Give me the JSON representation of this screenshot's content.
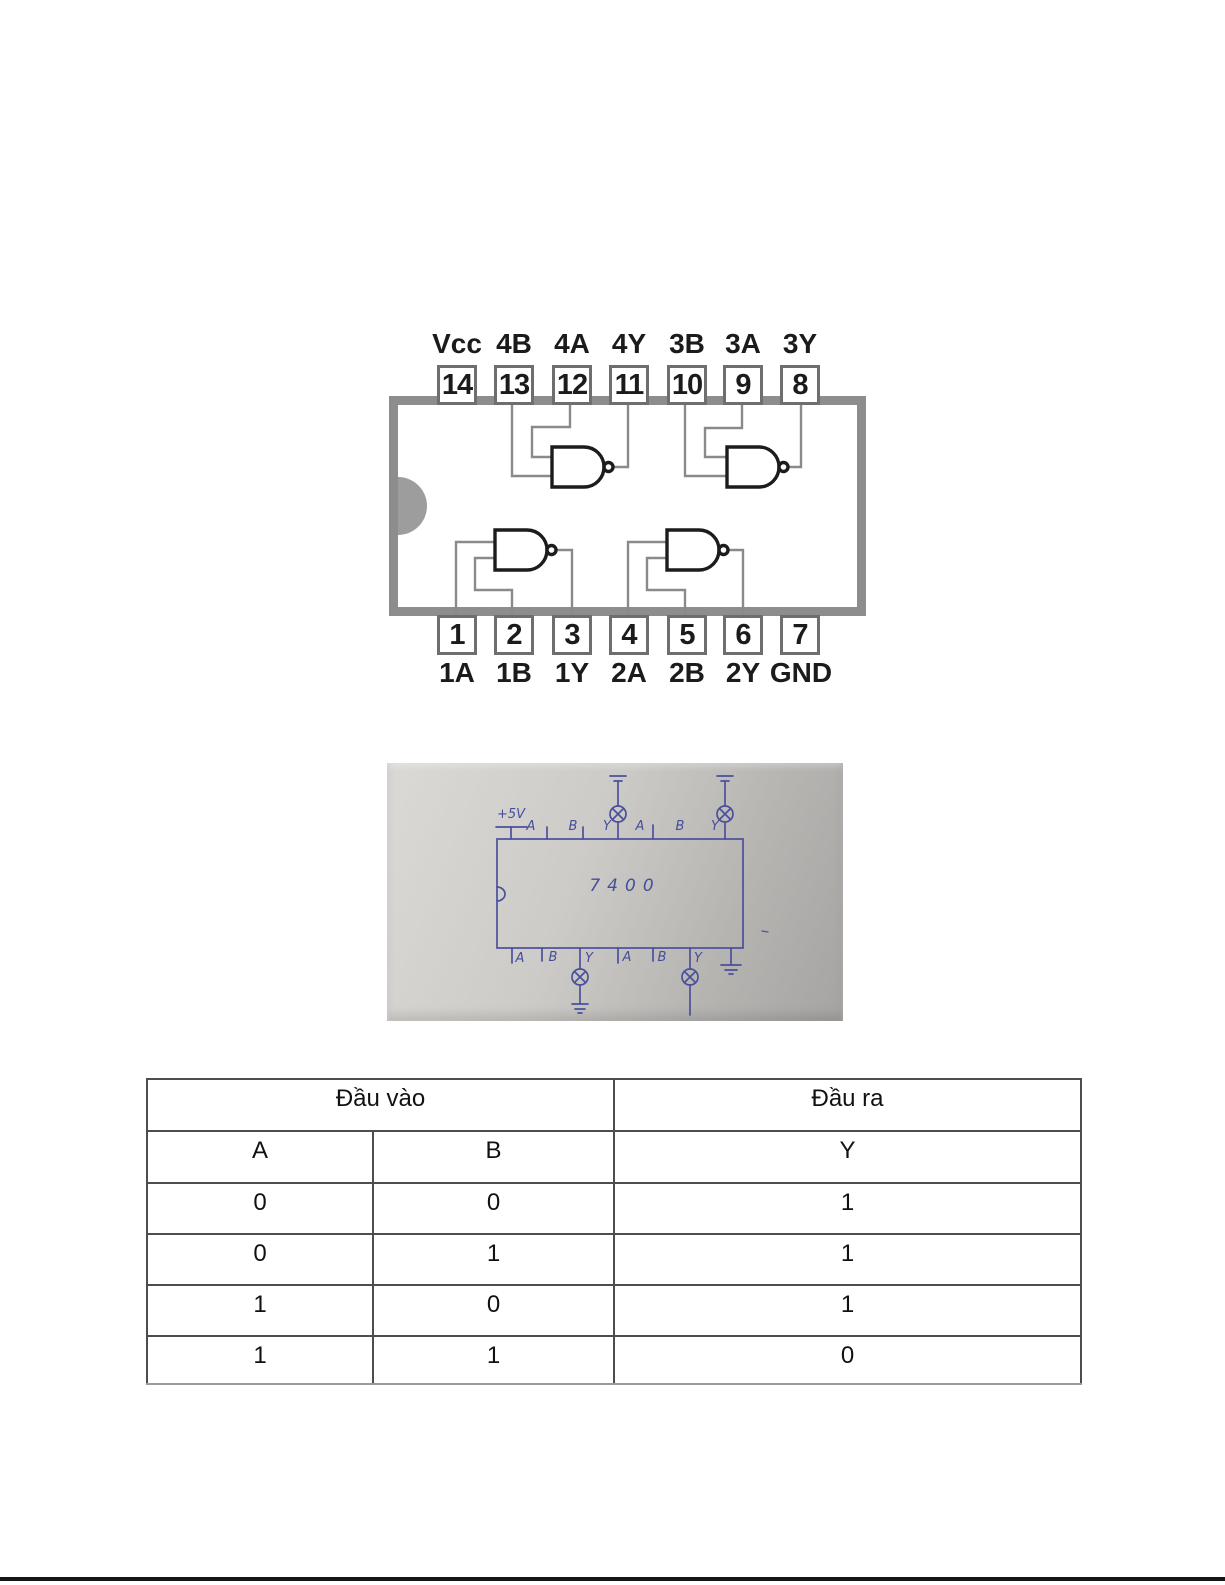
{
  "page": {
    "background": "#ffffff",
    "bottom_rule_color": "#151515"
  },
  "ic_pinout": {
    "gate_type": "NAND",
    "body_border_color": "#8d8d8d",
    "notch_color": "#9d9d9d",
    "wire_color": "#8a8a8a",
    "gate_color": "#1c1c1c",
    "top_pins": [
      {
        "number": "14",
        "label": "Vcc"
      },
      {
        "number": "13",
        "label": "4B"
      },
      {
        "number": "12",
        "label": "4A"
      },
      {
        "number": "11",
        "label": "4Y"
      },
      {
        "number": "10",
        "label": "3B"
      },
      {
        "number": "9",
        "label": "3A"
      },
      {
        "number": "8",
        "label": "3Y"
      }
    ],
    "bottom_pins": [
      {
        "number": "1",
        "label": "1A"
      },
      {
        "number": "2",
        "label": "1B"
      },
      {
        "number": "3",
        "label": "1Y"
      },
      {
        "number": "4",
        "label": "2A"
      },
      {
        "number": "5",
        "label": "2B"
      },
      {
        "number": "6",
        "label": "2Y"
      },
      {
        "number": "7",
        "label": "GND"
      }
    ]
  },
  "photo": {
    "chip_label": "7400",
    "supply_label": "+5V",
    "top_pin_labels": [
      "A",
      "B",
      "Y",
      "A",
      "B",
      "Y"
    ],
    "bottom_pin_labels": [
      "A",
      "B",
      "Y",
      "A",
      "B",
      "Y"
    ],
    "ink_color": "#454e9b",
    "paper_color_light": "#dad8d4",
    "paper_color_dark": "#a5a4a2",
    "icons": {
      "lamp_icon": "circle-with-x",
      "ground_icon": "stacked-horizontal-bars",
      "power_icon": "t-bar-rail"
    }
  },
  "truth_table": {
    "input_header": "Đầu vào",
    "output_header": "Đầu ra",
    "columns": [
      "A",
      "B",
      "Y"
    ],
    "rows": [
      [
        "0",
        "0",
        "1"
      ],
      [
        "0",
        "1",
        "1"
      ],
      [
        "1",
        "0",
        "1"
      ],
      [
        "1",
        "1",
        "0"
      ]
    ]
  }
}
